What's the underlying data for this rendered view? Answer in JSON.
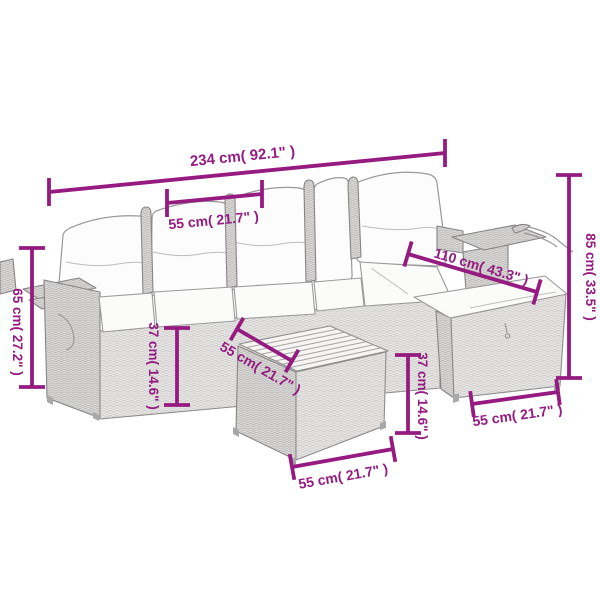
{
  "figure": {
    "background_color": "#ffffff",
    "dimension_color": "#951b81",
    "outline_color": "#8d8d8d",
    "dimensions": {
      "total_width": "234 cm( 92.1\" )",
      "seat_width": "55 cm( 21.7\" )",
      "armrest_height": "65 cm( 27.2\" )",
      "seat_height": "37 cm( 14.6\" )",
      "depth": "110 cm( 43.3\" )",
      "total_height": "85 cm( 33.5\" )",
      "footstool_top_depth": "55 cm( 21.7\" )",
      "footstool_height": "37 cm( 14.6\" )",
      "footstool_width": "55 cm( 21.7\" )",
      "right_seat_width": "55 cm( 21.7\" )"
    }
  }
}
